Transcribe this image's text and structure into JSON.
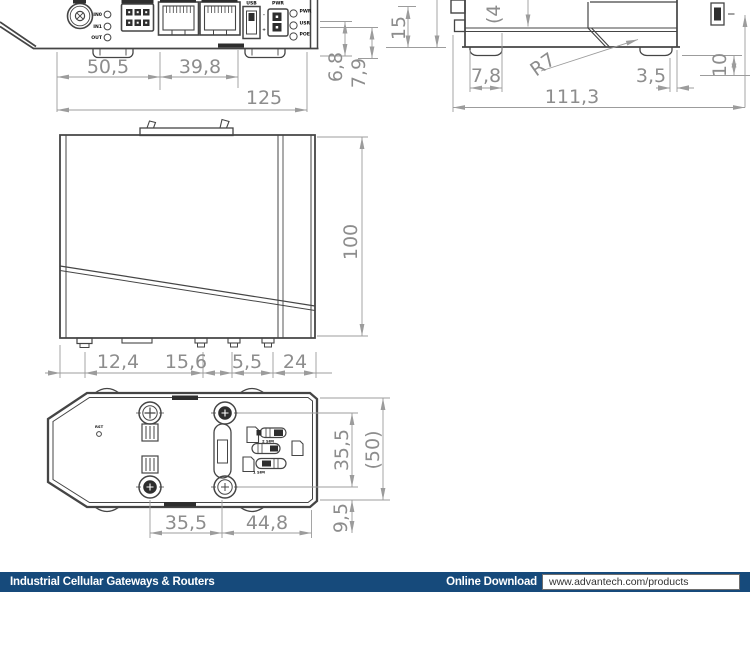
{
  "footer": {
    "bar_color": "#164a7b",
    "series_title": "Industrial Cellular Gateways & Routers",
    "download_label": "Online Download",
    "download_url": "www.advantech.com/products"
  },
  "front_view": {
    "io_labels": [
      "IN0",
      "IN1",
      "OUT"
    ],
    "usb_label": "USB",
    "pwr_label": "PWR",
    "plus": "+",
    "minus": "-",
    "led_labels": [
      "PWR",
      "USR",
      "POE"
    ],
    "dims": {
      "seg1": "50,5",
      "seg2": "39,8",
      "total": "125",
      "h1": "6,8",
      "h2": "7,9",
      "h3": "15"
    }
  },
  "side_view": {
    "dims": {
      "cut_top": "(4",
      "foot_left": "7,8",
      "radius": "R7",
      "foot_right": "3,5",
      "total": "111,3",
      "height": "10"
    }
  },
  "top_view": {
    "dims": {
      "height": "100",
      "seg1": "12,4",
      "seg2": "15,6",
      "seg3": "5,5",
      "seg4": "24"
    }
  },
  "bottom_view": {
    "rst_label": "RST",
    "sim2_label": "2 SIM",
    "sim1_label": "1 SIM",
    "dims": {
      "screws_v": "35,5",
      "overall_v": "(50)",
      "screws_h1": "35,5",
      "screws_h2": "44,8",
      "offset": "9,5"
    }
  }
}
